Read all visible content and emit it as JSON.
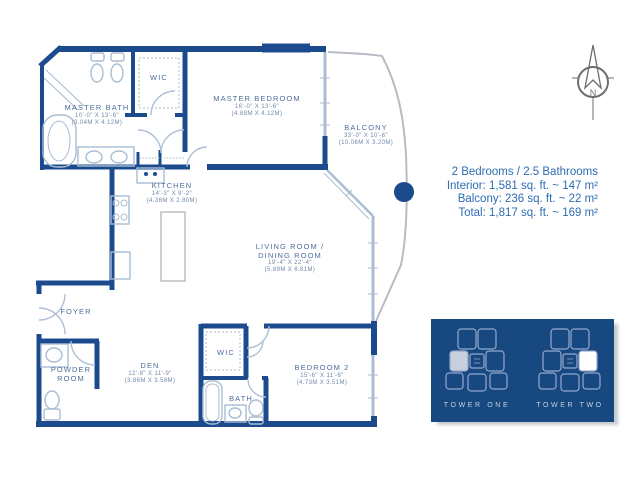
{
  "colors": {
    "wall_navy": "#1b4b8c",
    "fixture_blue": "#a9bdd3",
    "balcony_gray": "#b6bcc3",
    "label_slate": "#4e6d9c",
    "summary_blue": "#2d6cb3",
    "panel_navy": "#17487f",
    "keyplan_line": "#93a9cf",
    "highlight_tower_one": "#c6cfdb",
    "highlight_tower_two": "#ffffff"
  },
  "rooms": {
    "master_bath": {
      "name": "MASTER BATH",
      "dim_ft": "10'-0\" X 13'-6\"",
      "dim_m": "(3.04M X 4.12M)"
    },
    "wic_upper": {
      "name": "WIC"
    },
    "master_bedroom": {
      "name": "MASTER BEDROOM",
      "dim_ft": "16'-0\" X 13'-6\"",
      "dim_m": "(4.88M X 4.12M)"
    },
    "balcony": {
      "name": "BALCONY",
      "dim_ft": "33'-0\" X 10'-6\"",
      "dim_m": "(10.06M X 3.20M)"
    },
    "kitchen": {
      "name": "KITCHEN",
      "dim_ft": "14'-3\" X 9'-2\"",
      "dim_m": "(4.36M X 2.80M)"
    },
    "living_dining": {
      "name1": "LIVING ROOM /",
      "name2": "DINING ROOM",
      "dim_ft": "19'-4\" X 22'-4\"",
      "dim_m": "(5.89M X 6.81M)"
    },
    "foyer": {
      "name": "FOYER"
    },
    "powder_room": {
      "name1": "POWDER",
      "name2": "ROOM"
    },
    "den": {
      "name": "DEN",
      "dim_ft": "12'-8\" X 11'-9\"",
      "dim_m": "(3.86M X 3.58M)"
    },
    "wic_lower": {
      "name": "WIC"
    },
    "bath": {
      "name": "BATH"
    },
    "bedroom_2": {
      "name": "BEDROOM 2",
      "dim_ft": "15'-6\" X 11'-6\"",
      "dim_m": "(4.73M X 3.51M)"
    }
  },
  "summary": {
    "line1": "2 Bedrooms / 2.5 Bathrooms",
    "line2": "Interior: 1,581 sq. ft. ~ 147 m²",
    "line3": "Balcony: 236 sq. ft. ~ 22 m²",
    "line4": "Total: 1,817 sq. ft. ~ 169 m²"
  },
  "towers": {
    "tower_one": {
      "label": "TOWER ONE"
    },
    "tower_two": {
      "label": "TOWER TWO"
    }
  },
  "compass": {
    "north_label": "N"
  }
}
